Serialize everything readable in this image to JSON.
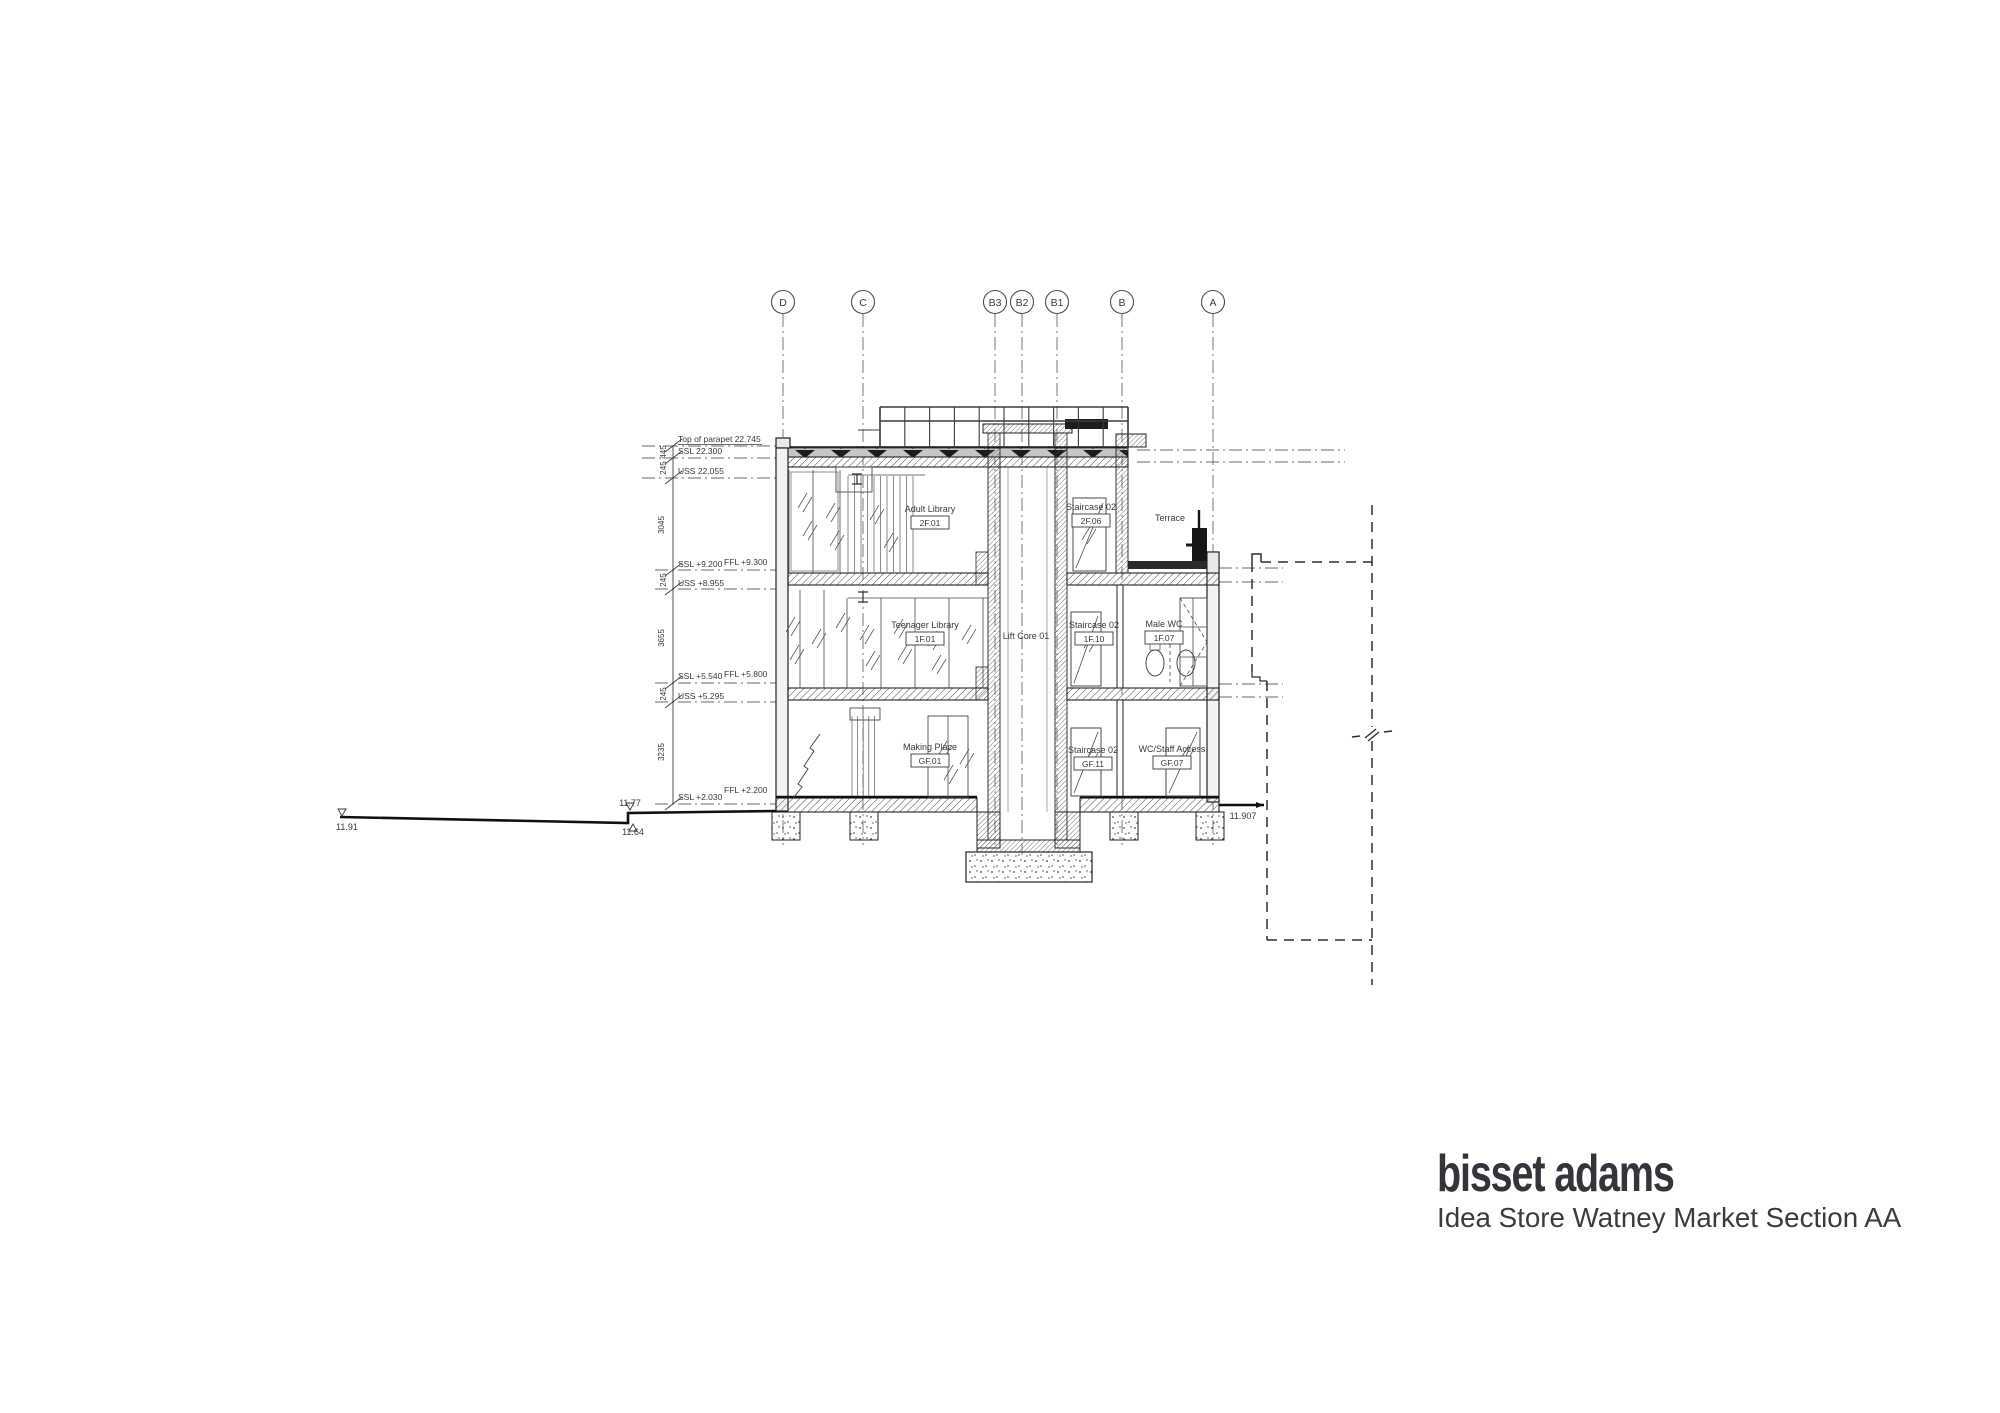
{
  "title_block": {
    "firm": "bisset adams",
    "drawing_title": "Idea Store Watney Market Section AA"
  },
  "grids": {
    "bubble_y": 302,
    "bubbles": [
      {
        "label": "D",
        "x": 783
      },
      {
        "label": "C",
        "x": 863
      },
      {
        "label": "B3",
        "x": 995
      },
      {
        "label": "B2",
        "x": 1022
      },
      {
        "label": "B1",
        "x": 1057
      },
      {
        "label": "B",
        "x": 1122
      },
      {
        "label": "A",
        "x": 1213
      }
    ]
  },
  "level_annotations": [
    {
      "text": "Top of parapet 22.745",
      "x": 678,
      "y": 442,
      "underline": true
    },
    {
      "text": "SSL 22.300",
      "x": 678,
      "y": 454
    },
    {
      "text": "USS 22.055",
      "x": 678,
      "y": 474
    },
    {
      "text": "SSL +9.200",
      "x": 678,
      "y": 567
    },
    {
      "text": "FFL +9.300",
      "x": 724,
      "y": 565
    },
    {
      "text": "USS +8.955",
      "x": 678,
      "y": 586
    },
    {
      "text": "SSL +5.540",
      "x": 678,
      "y": 679
    },
    {
      "text": "FFL +5.800",
      "x": 724,
      "y": 677
    },
    {
      "text": "USS +5.295",
      "x": 678,
      "y": 699
    },
    {
      "text": "SSL +2.030",
      "x": 678,
      "y": 800
    },
    {
      "text": "FFL +2.200",
      "x": 724,
      "y": 793
    }
  ],
  "dimension_texts": [
    {
      "text": "445",
      "x": 666,
      "y": 452
    },
    {
      "text": "245",
      "x": 666,
      "y": 468
    },
    {
      "text": "3045",
      "x": 664,
      "y": 525
    },
    {
      "text": "245",
      "x": 666,
      "y": 580
    },
    {
      "text": "3655",
      "x": 664,
      "y": 638
    },
    {
      "text": "245",
      "x": 666,
      "y": 694
    },
    {
      "text": "3235",
      "x": 664,
      "y": 752
    }
  ],
  "room_labels": [
    {
      "name": "Adult Library",
      "tag": "2F.01",
      "x": 930,
      "y": 512
    },
    {
      "name": "Staircase 02",
      "tag": "2F.06",
      "x": 1091,
      "y": 510
    },
    {
      "name": "Terrace",
      "tag": "",
      "x": 1170,
      "y": 521
    },
    {
      "name": "Teenager Library",
      "tag": "1F.01",
      "x": 925,
      "y": 628
    },
    {
      "name": "Lift Core 01",
      "tag": "",
      "x": 1026,
      "y": 639
    },
    {
      "name": "Staircase 02",
      "tag": "1F.10",
      "x": 1094,
      "y": 628
    },
    {
      "name": "Male WC",
      "tag": "1F.07",
      "x": 1164,
      "y": 627
    },
    {
      "name": "Making Place",
      "tag": "GF.01",
      "x": 930,
      "y": 750
    },
    {
      "name": "Staircase 02",
      "tag": "GF.11",
      "x": 1093,
      "y": 753
    },
    {
      "name": "WC/Staff Access",
      "tag": "GF.07",
      "x": 1172,
      "y": 752
    }
  ],
  "spot_levels": [
    {
      "text": "11.91",
      "x": 336,
      "y": 830,
      "anchor": "start"
    },
    {
      "text": "11.77",
      "x": 630,
      "y": 806,
      "anchor": "middle"
    },
    {
      "text": "11.64",
      "x": 633,
      "y": 835,
      "anchor": "middle"
    },
    {
      "text": "11.907",
      "x": 1243,
      "y": 819,
      "anchor": "middle"
    }
  ]
}
